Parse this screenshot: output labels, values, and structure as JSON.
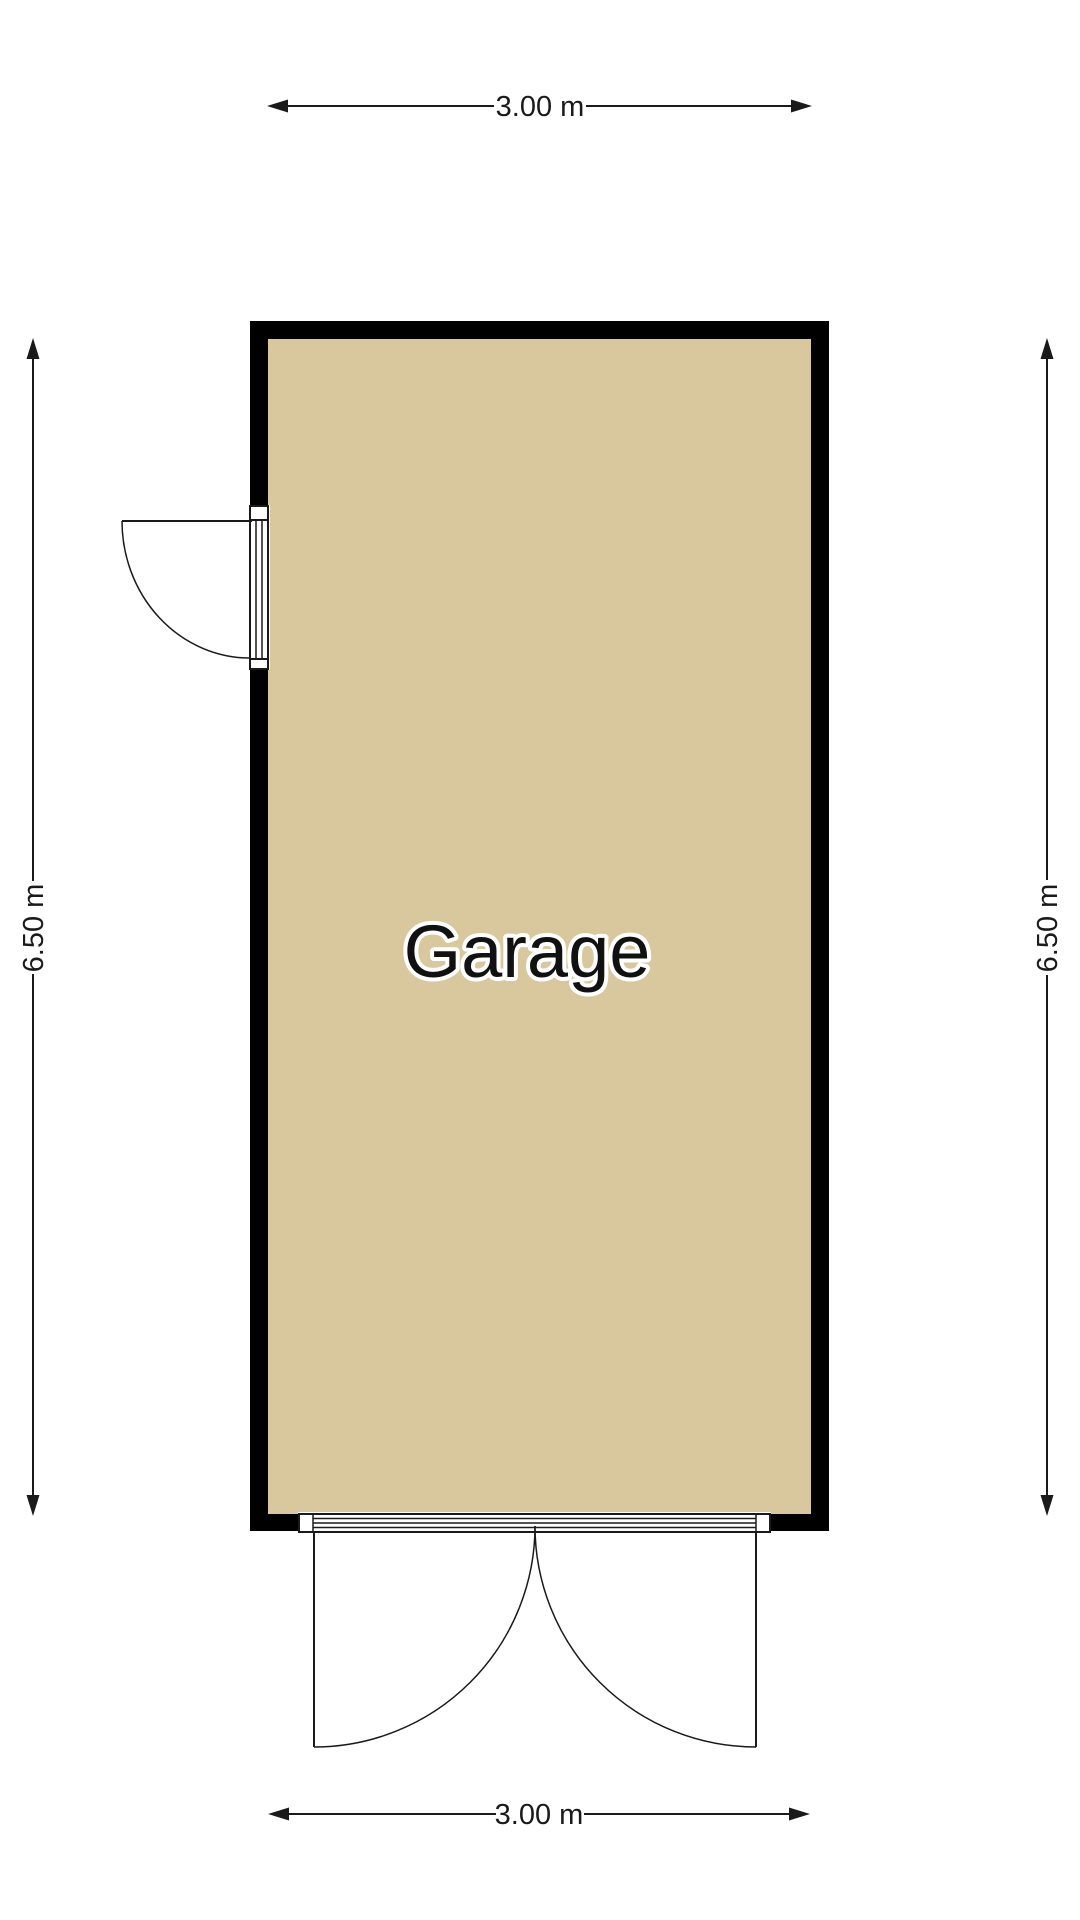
{
  "floorplan": {
    "room": {
      "label": "Garage"
    },
    "dimensions": {
      "width_top": "3.00 m",
      "width_bottom": "3.00 m",
      "height_left": "6.50 m",
      "height_right": "6.50 m"
    },
    "colors": {
      "floor_fill": "#d9c89e",
      "wall": "#000000",
      "line": "#1a1a1a",
      "background": "#ffffff",
      "label_text": "#111111",
      "label_outline": "#ffffff"
    }
  }
}
